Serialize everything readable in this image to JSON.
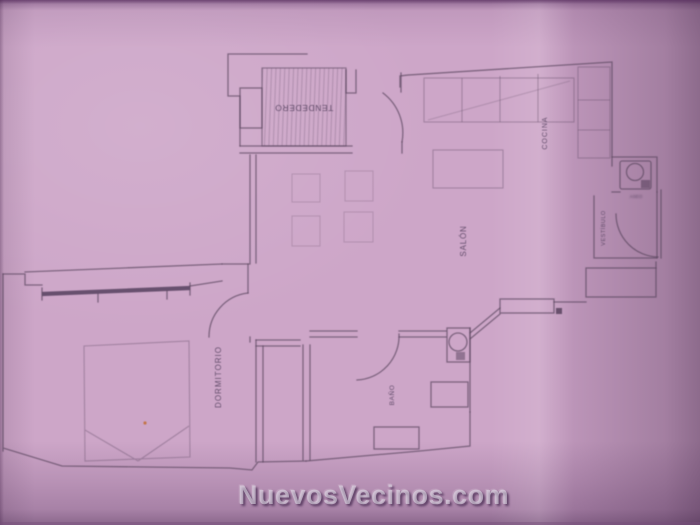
{
  "photo": {
    "description": "Blurred photo of an architectural floor plan printed on pink-tinted paper, rotated sideways",
    "paper_color": "#cda6c8",
    "ink_color": "#5e4a63",
    "speck_color": "#c2713d"
  },
  "watermark": {
    "text": "NuevosVecinos.com"
  },
  "floorplan": {
    "rooms": [
      {
        "id": "tendedero",
        "label": "TENDEDERO"
      },
      {
        "id": "cocina",
        "label": "COCINA"
      },
      {
        "id": "salon",
        "label": "SALÓN"
      },
      {
        "id": "vestibulo",
        "label": "VESTÍBULO"
      },
      {
        "id": "dormitorio",
        "label": "DORMITORIO"
      },
      {
        "id": "bano",
        "label": "BAÑO"
      },
      {
        "id": "aseo",
        "label": "ASEO"
      }
    ]
  }
}
